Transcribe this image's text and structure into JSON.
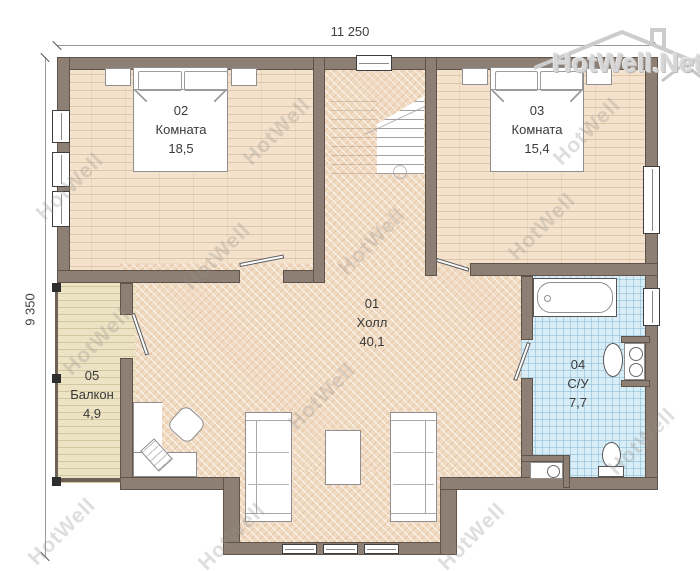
{
  "title": "Floor plan",
  "dimensions": {
    "width_label": "11 250",
    "height_label": "9 350"
  },
  "rooms": {
    "hall": {
      "number": "01",
      "name": "Холл",
      "area": "40,1"
    },
    "bedroom2": {
      "number": "02",
      "name": "Комната",
      "area": "18,5"
    },
    "bedroom3": {
      "number": "03",
      "name": "Комната",
      "area": "15,4"
    },
    "bathroom": {
      "number": "04",
      "name": "С/У",
      "area": "7,7"
    },
    "balcony": {
      "number": "05",
      "name": "Балкон",
      "area": "4,9"
    }
  },
  "watermark": {
    "text": "HotWell",
    "logo_text": "HotWell.Net"
  },
  "colors": {
    "wall": "#8d7f73",
    "wall_outline": "#4e443c",
    "bedroom_floor": "#f4e2cd",
    "hall_floor": "#f1dac2",
    "balcony_floor": "#ece3c4",
    "bathroom_tile": "#d9edf6",
    "label_text": "#3a3a3a"
  }
}
